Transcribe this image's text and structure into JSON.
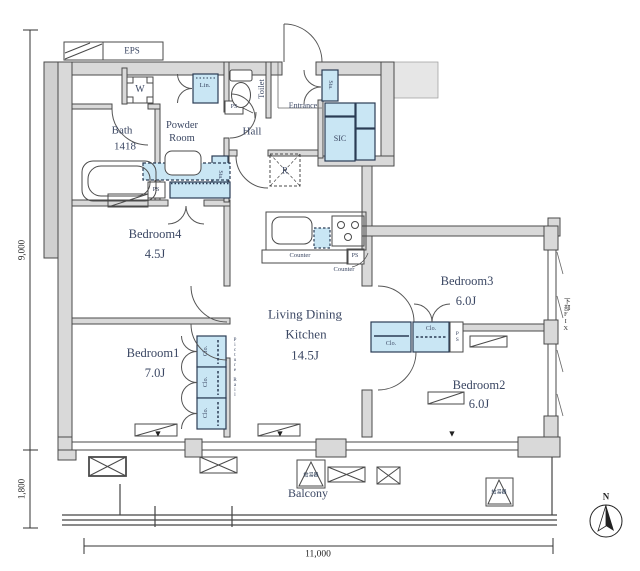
{
  "labels": {
    "eps": "EPS",
    "washer": "W",
    "linen": "Lin.",
    "toilet": "Toilet",
    "ps": "PS",
    "storage": "Sta.",
    "entrance": "Entrance",
    "shoe_closet": "SIC",
    "hall": "Hall",
    "fridge": "R",
    "closet": "Clo.",
    "counter": "Counter",
    "balcony": "Balcony",
    "water_heater": "給湯器",
    "lower_fix": "下部FIX",
    "picture_rail": "Picture Rail",
    "bath_name": "Bath",
    "bath_size": "1418",
    "powder_line1": "Powder",
    "powder_line2": "Room",
    "window_marker": "▼"
  },
  "rooms": {
    "bedroom1": {
      "name": "Bedroom1",
      "size": "7.0J"
    },
    "bedroom2": {
      "name": "Bedroom2",
      "size": "6.0J"
    },
    "bedroom3": {
      "name": "Bedroom3",
      "size": "6.0J"
    },
    "bedroom4": {
      "name": "Bedroom4",
      "size": "4.5J"
    },
    "ldk": {
      "line1": "Living Dining",
      "line2": "Kitchen",
      "size": "14.5J"
    }
  },
  "dimensions": {
    "left_main": "9,000",
    "left_balcony": "1,800",
    "bottom": "11,000"
  },
  "compass": {
    "label": "N"
  },
  "colors": {
    "wall_fill": "#d9d9d9",
    "wall_stroke": "#4a4a4a",
    "storage_fill": "#c9e6f4",
    "storage_border": "#2b3c55",
    "text": "#3b4763"
  }
}
